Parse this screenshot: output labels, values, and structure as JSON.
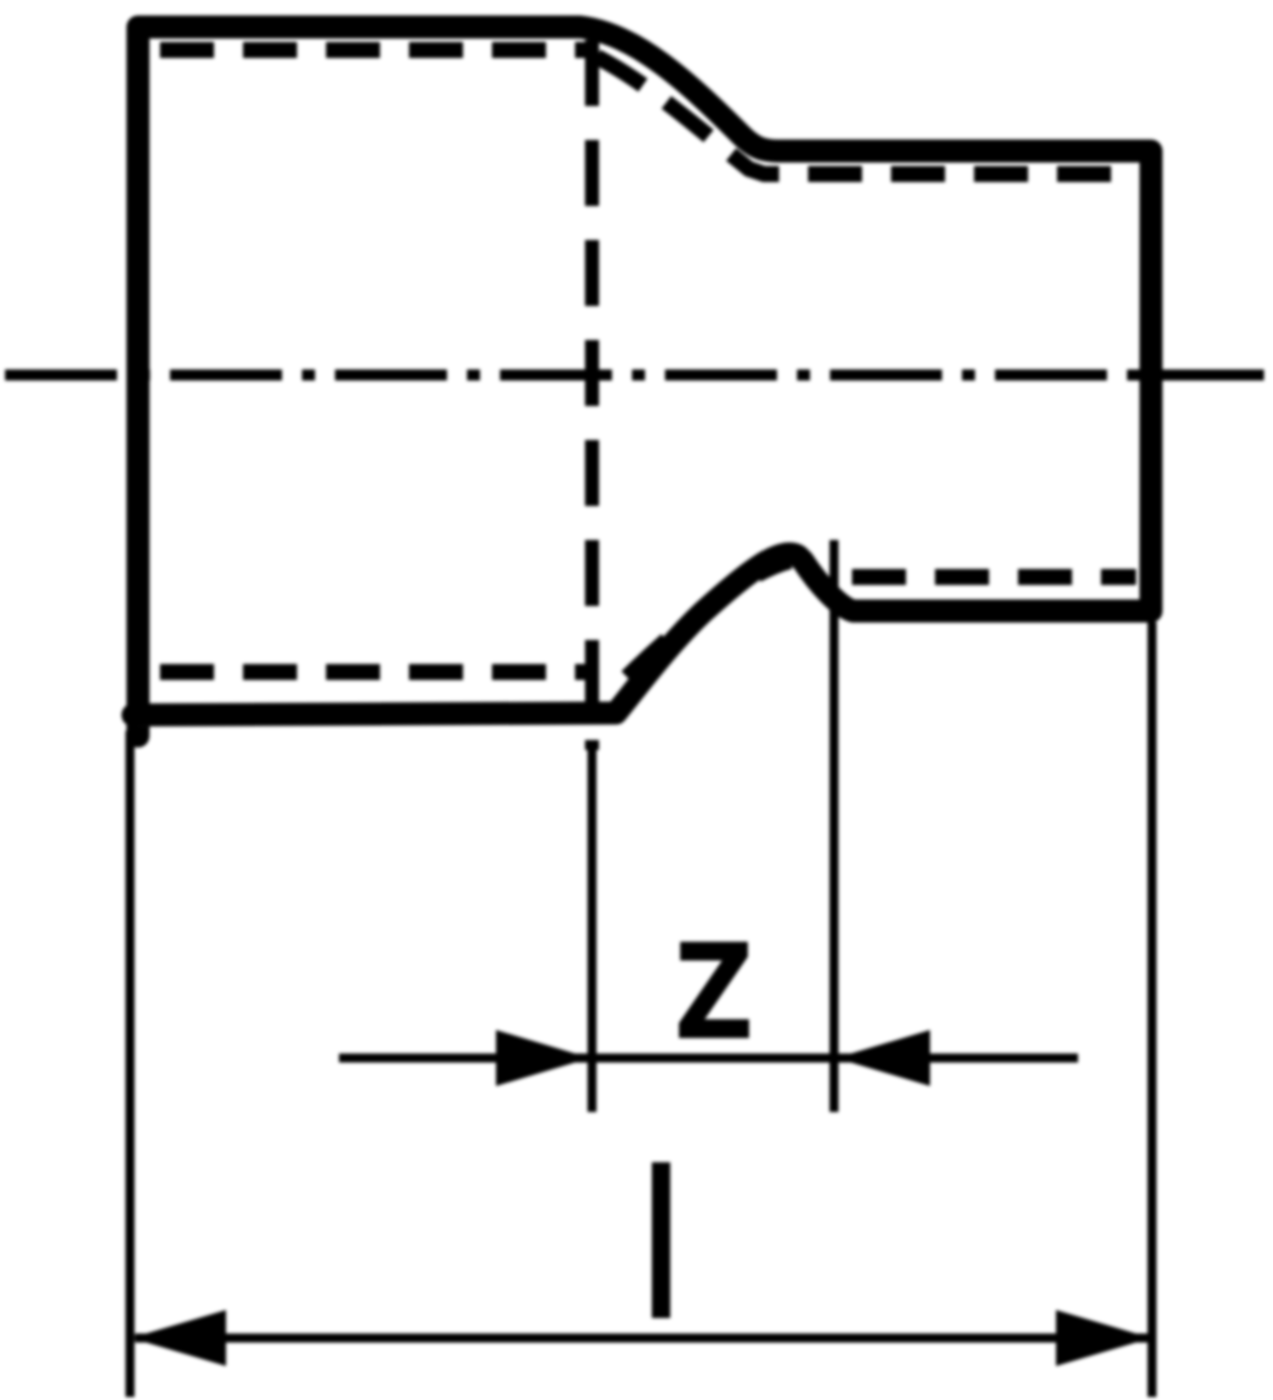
{
  "diagram": {
    "kind": "technical line drawing",
    "subject": "reducer pipe fitting, sectional side view with hidden bore lines and centerline",
    "colors": {
      "line": "#000000",
      "background": "#ffffff"
    },
    "dimensions": {
      "z": {
        "label": "Z"
      },
      "l": {
        "label": "l"
      }
    }
  }
}
